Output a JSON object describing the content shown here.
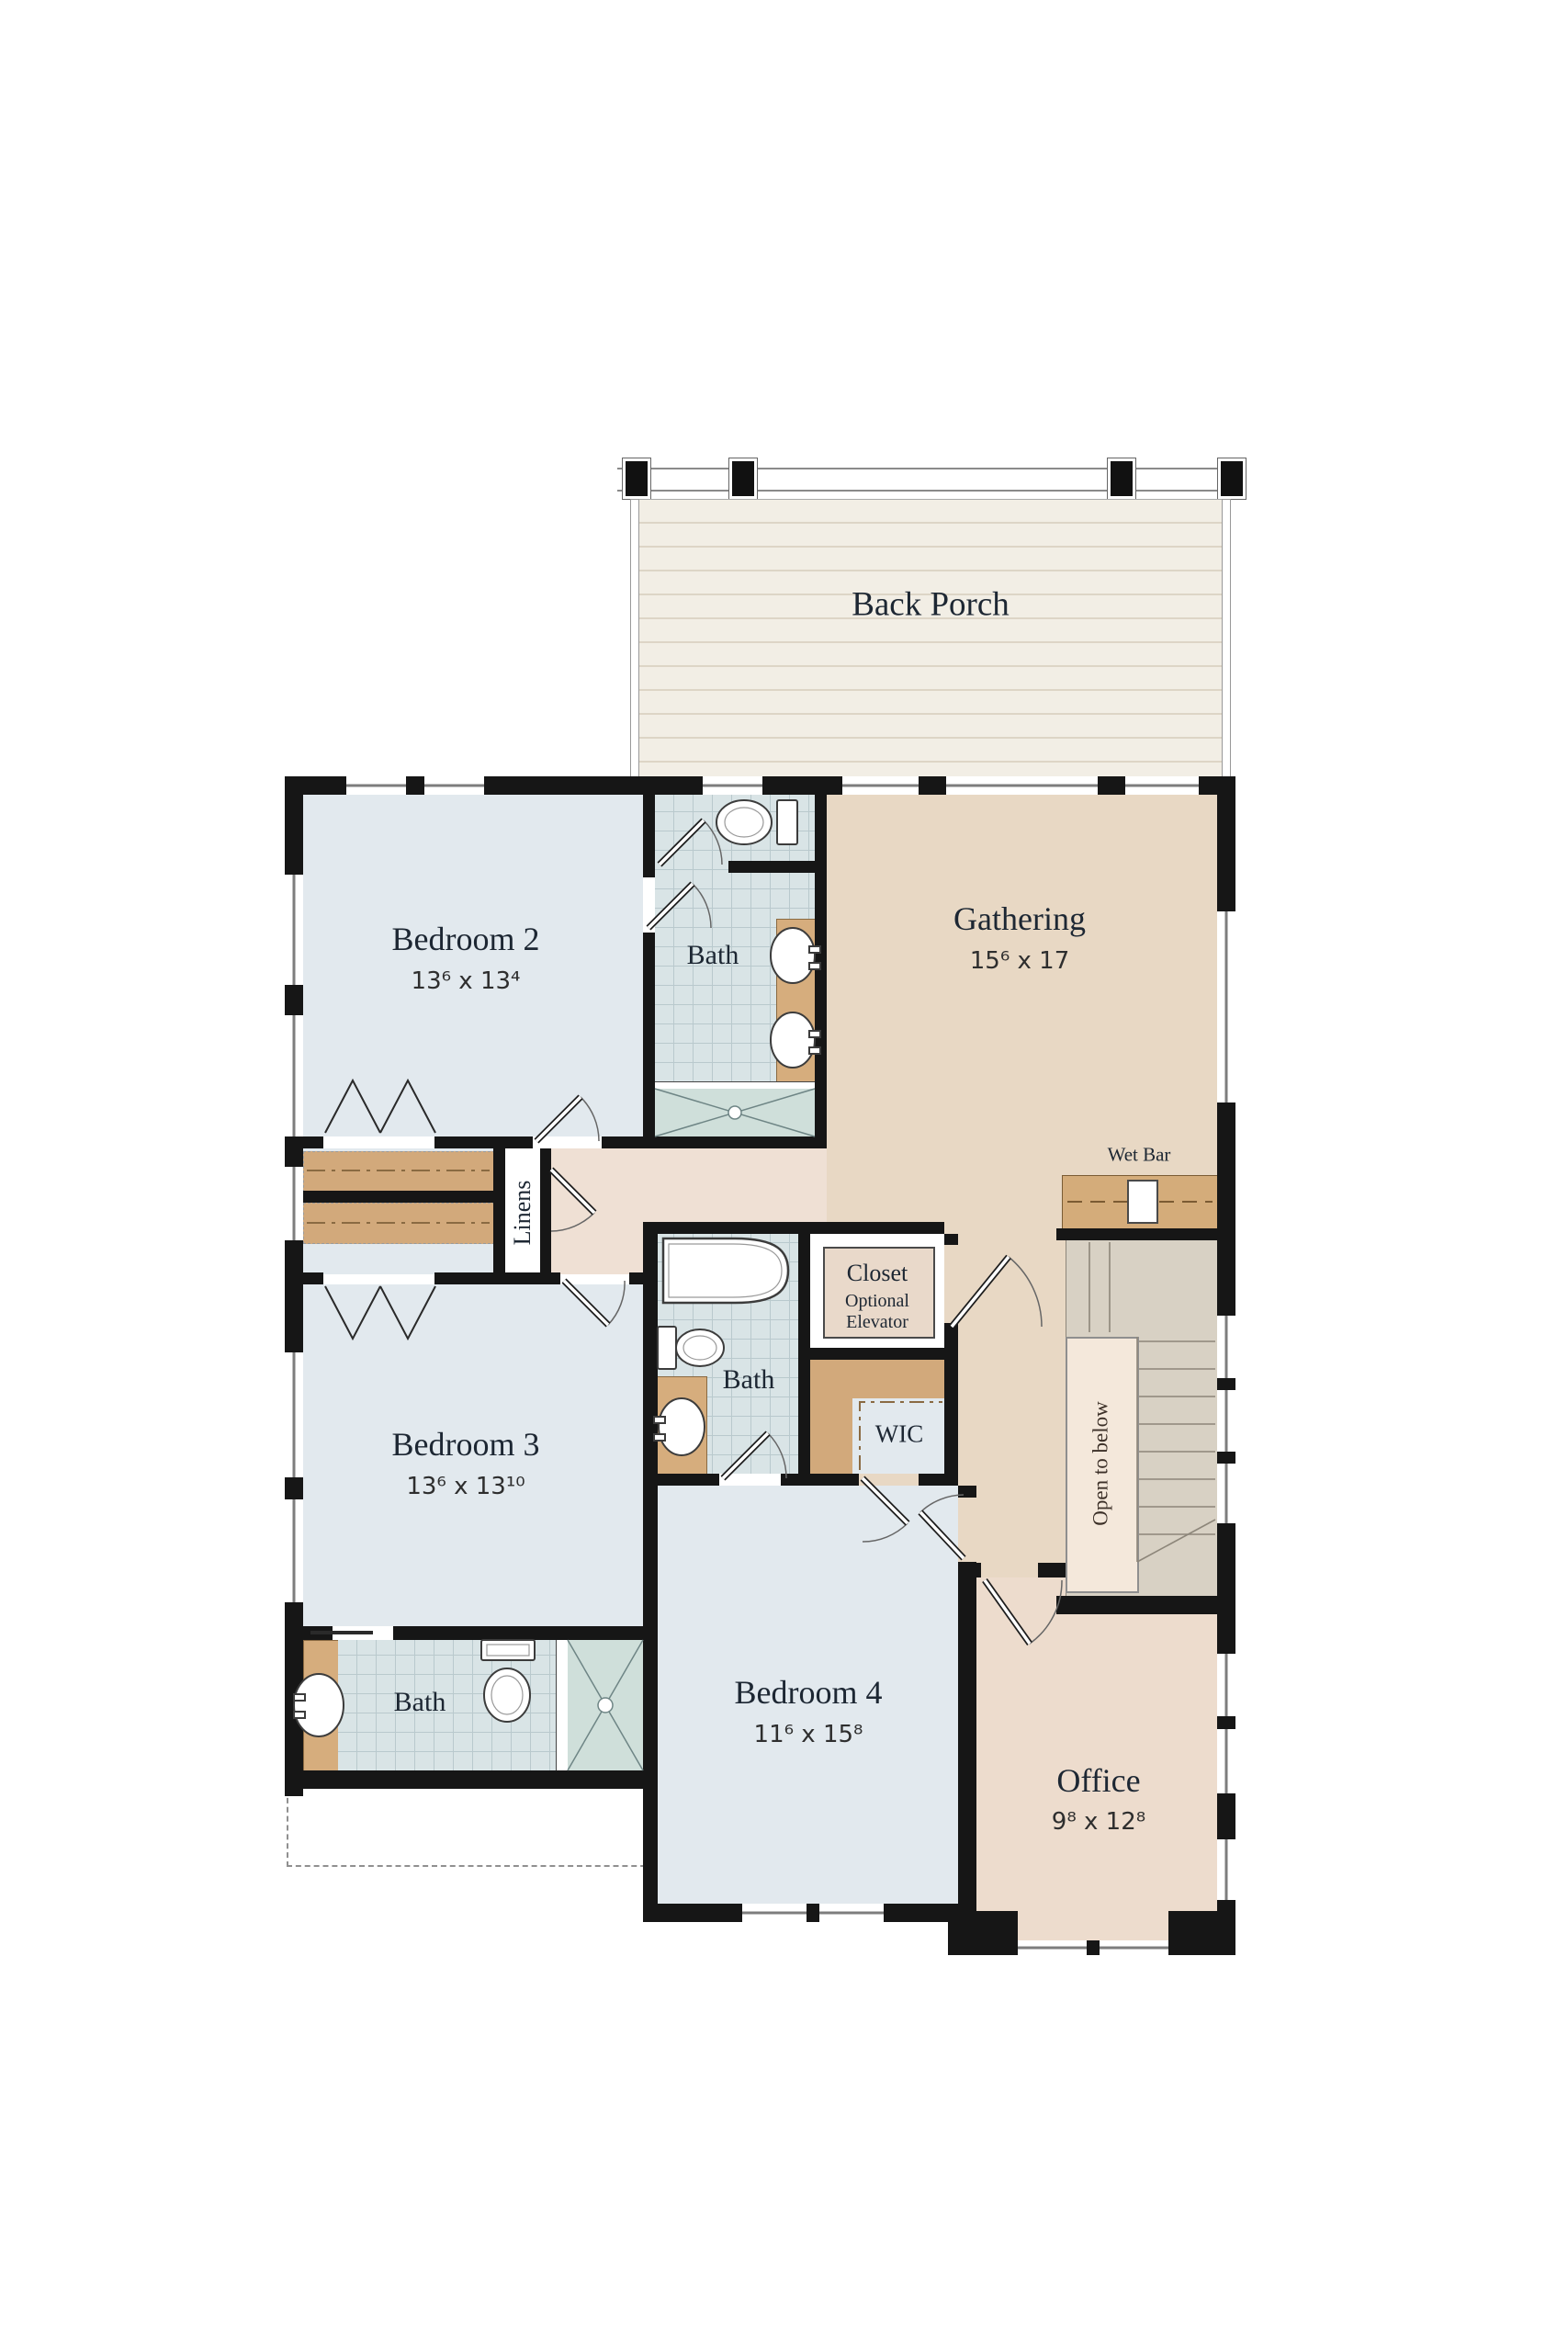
{
  "plan": {
    "type": "floor-plan",
    "colors": {
      "wall": "#161616",
      "bedroom_fill": "#e2e9ee",
      "gathering_fill": "#e8d8c4",
      "hall_fill": "#efe0d4",
      "office_fill": "#eddccd",
      "porch_fill": "#f2eee5",
      "tile_fill": "#d9e4e6",
      "shower_fill": "#cfdfda",
      "vanity_fill": "#d6ad7d",
      "stair_fill": "#d8d1c4",
      "open_shaft_fill": "#f4e8db"
    },
    "rooms": {
      "back_porch": {
        "name": "Back Porch"
      },
      "bedroom2": {
        "name": "Bedroom 2",
        "dims": "13⁶ x 13⁴"
      },
      "bath_upper": {
        "name": "Bath"
      },
      "gathering": {
        "name": "Gathering",
        "dims": "15⁶ x 17"
      },
      "wet_bar": {
        "name": "Wet Bar"
      },
      "linens": {
        "name": "Linens"
      },
      "closet": {
        "name": "Closet",
        "note_line1": "Optional",
        "note_line2": "Elevator"
      },
      "bath_middle": {
        "name": "Bath"
      },
      "wic": {
        "name": "WIC"
      },
      "stairwell": {
        "open_label": "Open to below"
      },
      "bedroom3": {
        "name": "Bedroom 3",
        "dims": "13⁶ x 13¹⁰"
      },
      "bath_lower": {
        "name": "Bath"
      },
      "bedroom4": {
        "name": "Bedroom 4",
        "dims": "11⁶ x 15⁸"
      },
      "office": {
        "name": "Office",
        "dims": "9⁸ x 12⁸"
      }
    }
  }
}
